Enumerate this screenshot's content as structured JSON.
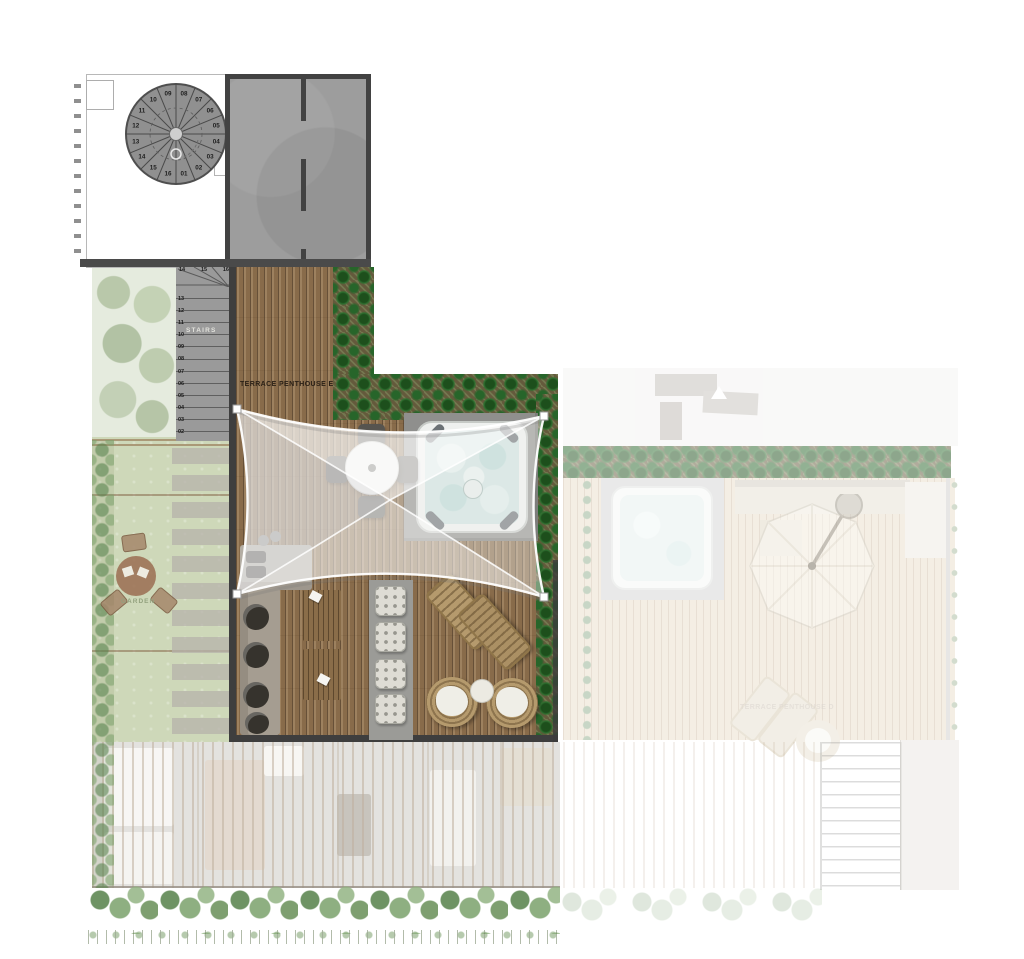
{
  "labels": {
    "terrace_e": "TERRACE PENTHOUSE E",
    "terrace_d": "TERRACE PENTHOUSE D",
    "garden": "GARDEN",
    "stairs": "STAIRS"
  },
  "spiral_staircase": {
    "treads_clockwise_from_top": [
      "08",
      "07",
      "06",
      "05",
      "04",
      "03",
      "02",
      "01",
      "16",
      "15",
      "14",
      "13",
      "12",
      "11",
      "10",
      "09"
    ]
  },
  "straight_staircase": {
    "winder_treads": [
      "14",
      "15",
      "16"
    ],
    "treads_top_to_bottom": [
      "13",
      "12",
      "11",
      "10",
      "09",
      "08",
      "07",
      "06",
      "05",
      "04",
      "03",
      "02"
    ]
  },
  "colors": {
    "deck_wood": "#8d7150",
    "hedge_green": "#2f7030",
    "lawn_green": "#c6d2ad",
    "roof_concrete": "#9d9d9d",
    "wall_dark": "#3e3e3e",
    "hot_tub_water": "#cde2e0",
    "sail_white": "#f5f5f3"
  }
}
